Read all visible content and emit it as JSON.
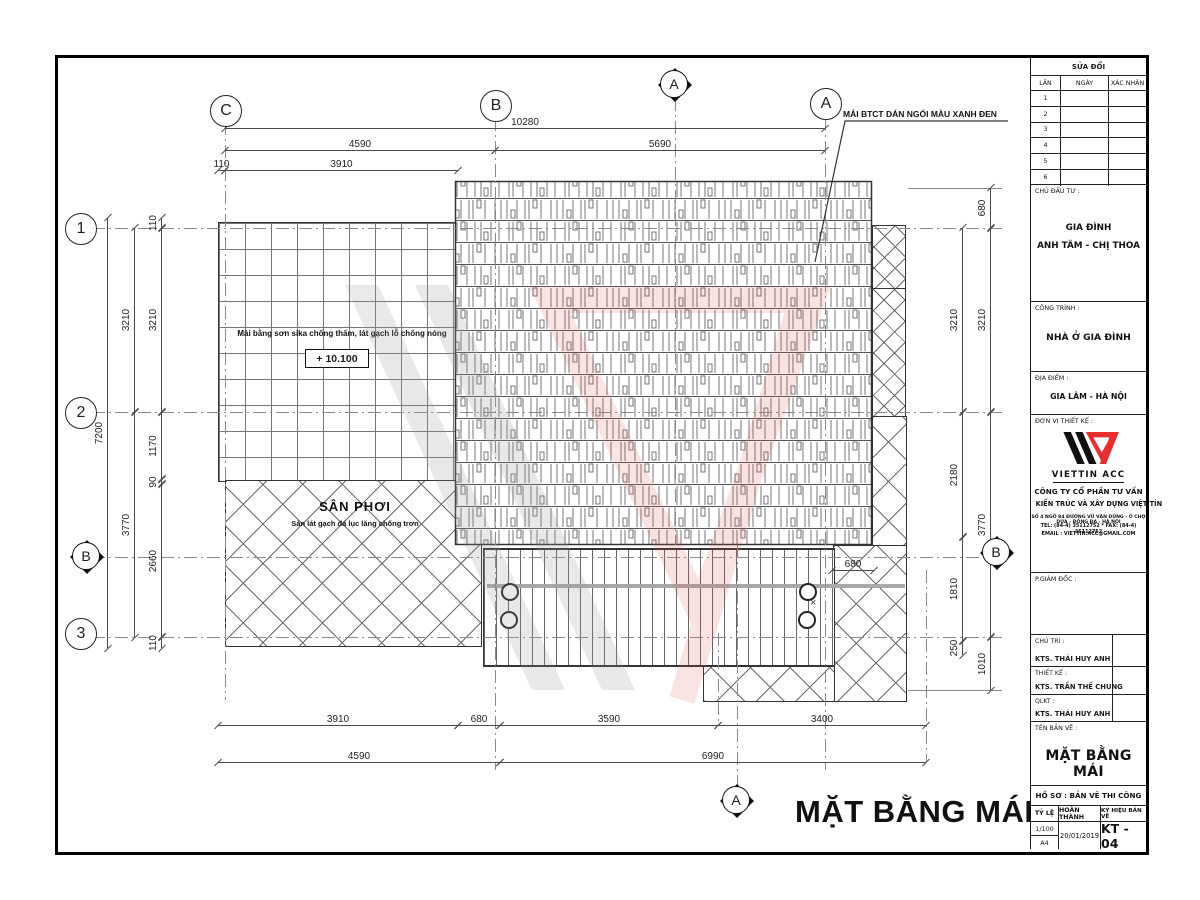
{
  "colors": {
    "line": "#3a3a3a",
    "logo_red": "#e62e2e",
    "watermark_red": "#e87878",
    "watermark_gray": "#9a9a9a"
  },
  "drawing": {
    "main_title": "MẶT BẰNG MÁI",
    "grid_columns": [
      "C",
      "B",
      "A"
    ],
    "grid_rows": [
      "1",
      "2",
      "3"
    ],
    "section_a": "A",
    "section_b": "B",
    "annotations": {
      "roof_note": "MÁI BTCT DÁN NGÓI MÀU XANH ĐEN",
      "flat_roof_note": "Mái bằng sơn sika chống thấm, lát gạch lỗ chống nóng",
      "level": "+ 10.100",
      "yard_title": "SÂN PHƠI",
      "yard_sub": "Sàn lát gạch đá lục lăng chống trơn",
      "cross": "×"
    },
    "dims": {
      "top_total": "10280",
      "top_c_b": "4590",
      "top_b_a": "5690",
      "top_off": "110",
      "top_inner": "3910",
      "left_total": "7200",
      "left_o1": "3210",
      "left_o2": "3770",
      "left_i0": "110",
      "left_i1": "3210",
      "left_i2": "1170",
      "left_i3": "90",
      "left_i4": "2660",
      "left_i5": "110",
      "right_o0": "680",
      "right_o1": "3210",
      "right_o2": "3770",
      "right_o3": "1010",
      "right_i1": "3210",
      "right_i2": "2180",
      "right_i3": "1810",
      "right_i4": "250",
      "bot_1": "3910",
      "bot_2": "680",
      "bot_3": "3590",
      "bot_4": "3400",
      "bot_t1": "4590",
      "bot_t2": "6990",
      "balcony": "680"
    }
  },
  "titleblock": {
    "revision": {
      "header": "SỬA ĐỔI",
      "cols": [
        "LẦN",
        "NGÀY",
        "XÁC NHẬN"
      ],
      "rows": [
        "1",
        "2",
        "3",
        "4",
        "5",
        "6"
      ]
    },
    "client": {
      "label": "CHỦ ĐẦU TƯ :",
      "line1": "GIA ĐÌNH",
      "line2": "ANH TÂM - CHỊ THOA"
    },
    "project": {
      "label": "CÔNG TRÌNH :",
      "name": "NHÀ Ở GIA ĐÌNH"
    },
    "location": {
      "label": "ĐỊA ĐIỂM :",
      "name": "GIA LÂM - HÀ NỘI"
    },
    "designer": {
      "label": "ĐƠN VỊ THIẾT KẾ :",
      "logo": "VIETTIN ACC",
      "company_line1": "CÔNG TY CỔ PHẦN TƯ VẤN",
      "company_line2": "KIẾN TRÚC VÀ XÂY DỰNG VIỆT TÍN",
      "address": "SỐ 4 NGÕ 84 ĐƯỜNG VŨ VĂN DŨNG - Ô CHỢ DỪA - ĐỐNG ĐA - HÀ NỘI",
      "phone": "TEL: (84-4) 35112752 * FAX: (84-4) 35112752",
      "email": "EMAIL : VIETTIN.ACC@GMAIL.COM"
    },
    "deputy_label": "P.GIÁM ĐỐC :",
    "staff": [
      {
        "label": "CHỦ TRÌ :",
        "name": "KTS. THÁI HUY ANH"
      },
      {
        "label": "THIẾT KẾ :",
        "name": "KTS. TRẦN THẾ CHUNG"
      },
      {
        "label": "QLKT :",
        "name": "KTS. THÁI HUY ANH"
      }
    ],
    "sheet": {
      "label": "TÊN BẢN VẼ :",
      "name": "MẶT BẰNG MÁI",
      "dossier": "HỒ SƠ : BẢN VẼ THI CÔNG",
      "scale_label": "TỶ LỆ",
      "finish_label": "HOÀN THÀNH",
      "code_label": "KÝ HIỆU BẢN VẼ",
      "scale": "1/100",
      "paper": "A4",
      "date": "20/01/2019",
      "code": "KT - 04"
    }
  }
}
